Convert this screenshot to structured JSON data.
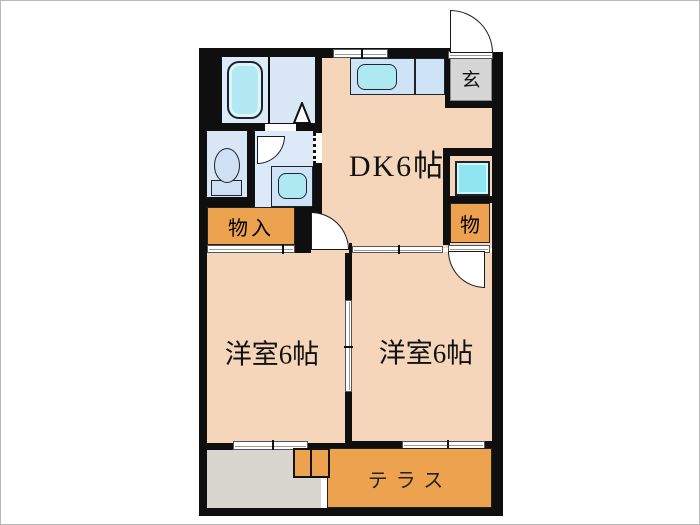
{
  "rooms": {
    "dk": {
      "label": "DK6帖"
    },
    "genkan": {
      "label": "玄"
    },
    "closet_left": {
      "label": "物入"
    },
    "closet_right": {
      "label": "物"
    },
    "room_left": {
      "label": "洋室6帖"
    },
    "room_right": {
      "label": "洋室6帖"
    },
    "terrace": {
      "label": "テラス"
    }
  },
  "colors": {
    "wall": "#0f0f0f",
    "floor_peach": "#f5d6ba",
    "accent_orange": "#eca24f",
    "entrance_gray": "#d6d6d6",
    "approach_gray": "#d9d5cf",
    "room_blue": "#d9e7f7",
    "water_cyan": "#aee9f2"
  }
}
